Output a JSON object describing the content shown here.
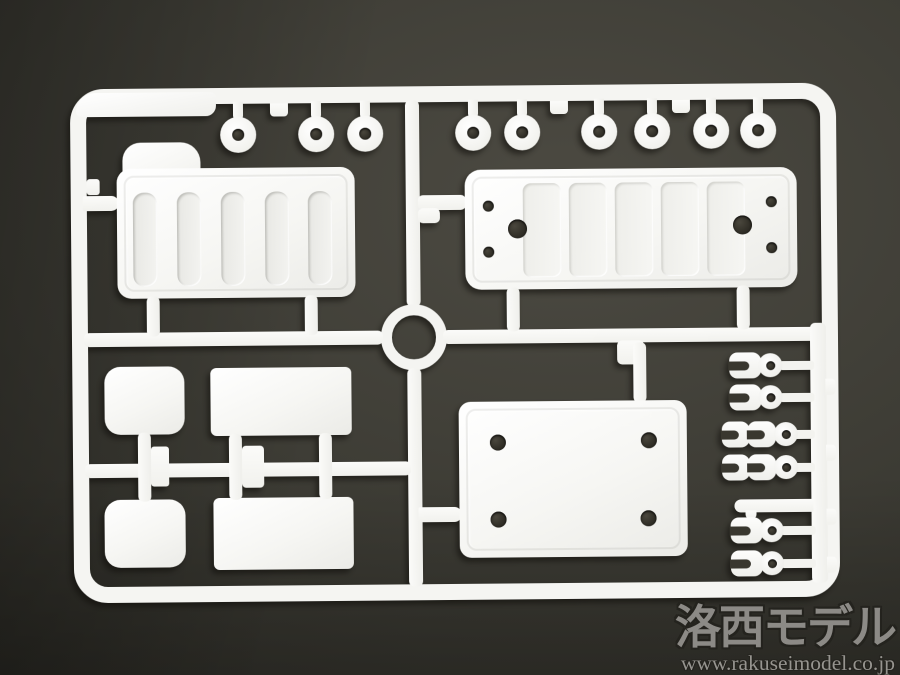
{
  "meta": {
    "subject": "Photograph of a white injection-molded plastic model kit sprue (parts runner) on a dark gray studio background"
  },
  "watermark": {
    "brand": "洛西モデル",
    "url": "www.rakuseimodel.co.jp"
  },
  "colors": {
    "plastic": "#f5f5f2",
    "background": "#3b3a33",
    "hole": "#2f2d26",
    "wm_text": "#908e8a",
    "wm_url_text": "#9b9994",
    "wm_outline": "#24231e"
  },
  "sprue": {
    "top_rings_x": [
      240,
      318,
      367,
      475,
      524,
      601,
      654,
      713,
      760
    ],
    "top_rings_y": 133,
    "top_frame_tabs_x": [
      272,
      552,
      674
    ],
    "canopy_grooves_x": [
      134,
      178,
      222,
      266,
      309
    ],
    "plate_panels_x": [
      524,
      570,
      616,
      662,
      708
    ],
    "plate_holes_small": [
      [
        489,
        206
      ],
      [
        489,
        252
      ],
      [
        772,
        204
      ],
      [
        772,
        250
      ]
    ],
    "plate_holes_large": [
      [
        518,
        229
      ],
      [
        743,
        227
      ]
    ],
    "base_plate_holes": [
      [
        497,
        443
      ],
      [
        648,
        442
      ],
      [
        497,
        520
      ],
      [
        647,
        520
      ]
    ],
    "runner_side_tabs_y": [
      382,
      448,
      512,
      560
    ],
    "fork_parts": [
      {
        "y": 368,
        "double": false
      },
      {
        "y": 400,
        "double": false
      },
      {
        "y": 437,
        "double": true
      },
      {
        "y": 470,
        "double": true
      },
      {
        "y": 533,
        "double": false
      },
      {
        "y": 566,
        "double": false
      }
    ]
  }
}
